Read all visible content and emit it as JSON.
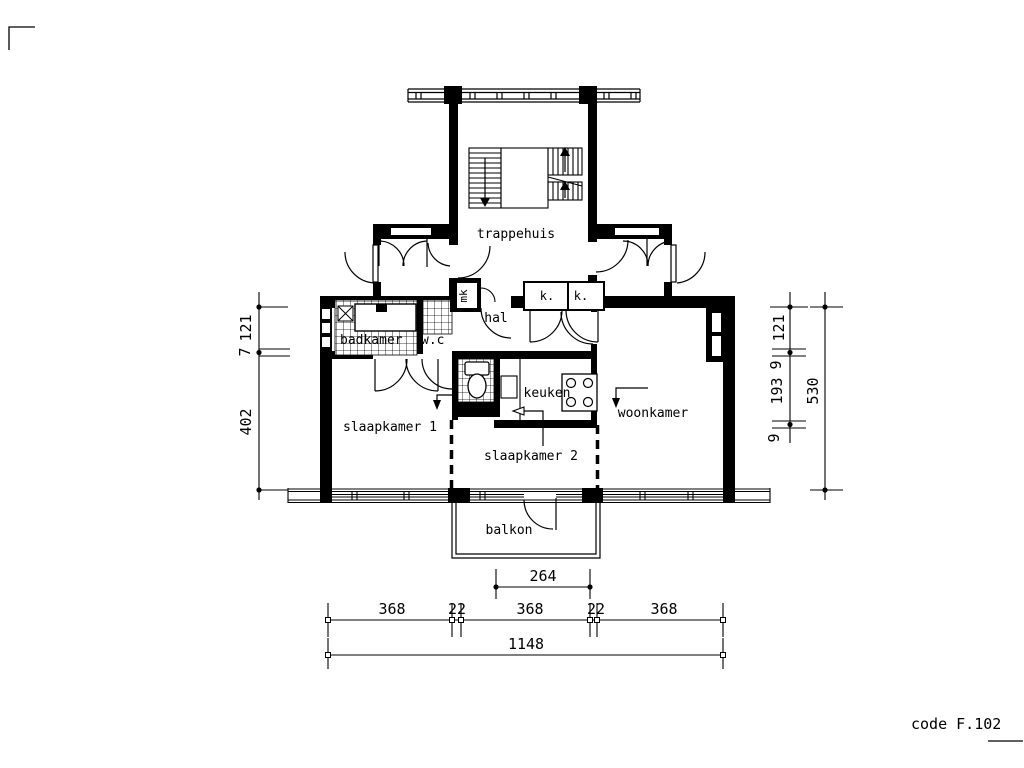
{
  "sheet": {
    "code": "code F.102"
  },
  "rooms": {
    "trappehuis": "trappehuis",
    "hal": "hal",
    "meterkast": "mk",
    "closet_left": "k.",
    "closet_right": "k.",
    "badkamer": "badkamer",
    "wc": "w.c",
    "keuken": "keuken",
    "slaapkamer1": "slaapkamer 1",
    "slaapkamer2": "slaapkamer 2",
    "woonkamer": "woonkamer",
    "balkon": "balkon"
  },
  "dimensions": {
    "left": {
      "seg1": "121",
      "seg2": "7",
      "seg3": "402"
    },
    "right": {
      "seg1": "121",
      "seg2": "9",
      "seg3": "193",
      "seg4": "9",
      "overall": "530"
    },
    "bottom": {
      "balcony": "264",
      "bay1": "368",
      "gap1": "22",
      "bay2": "368",
      "gap2": "22",
      "bay3": "368",
      "overall": "1148"
    }
  },
  "colors": {
    "ink": "#000000",
    "paper": "#ffffff"
  }
}
